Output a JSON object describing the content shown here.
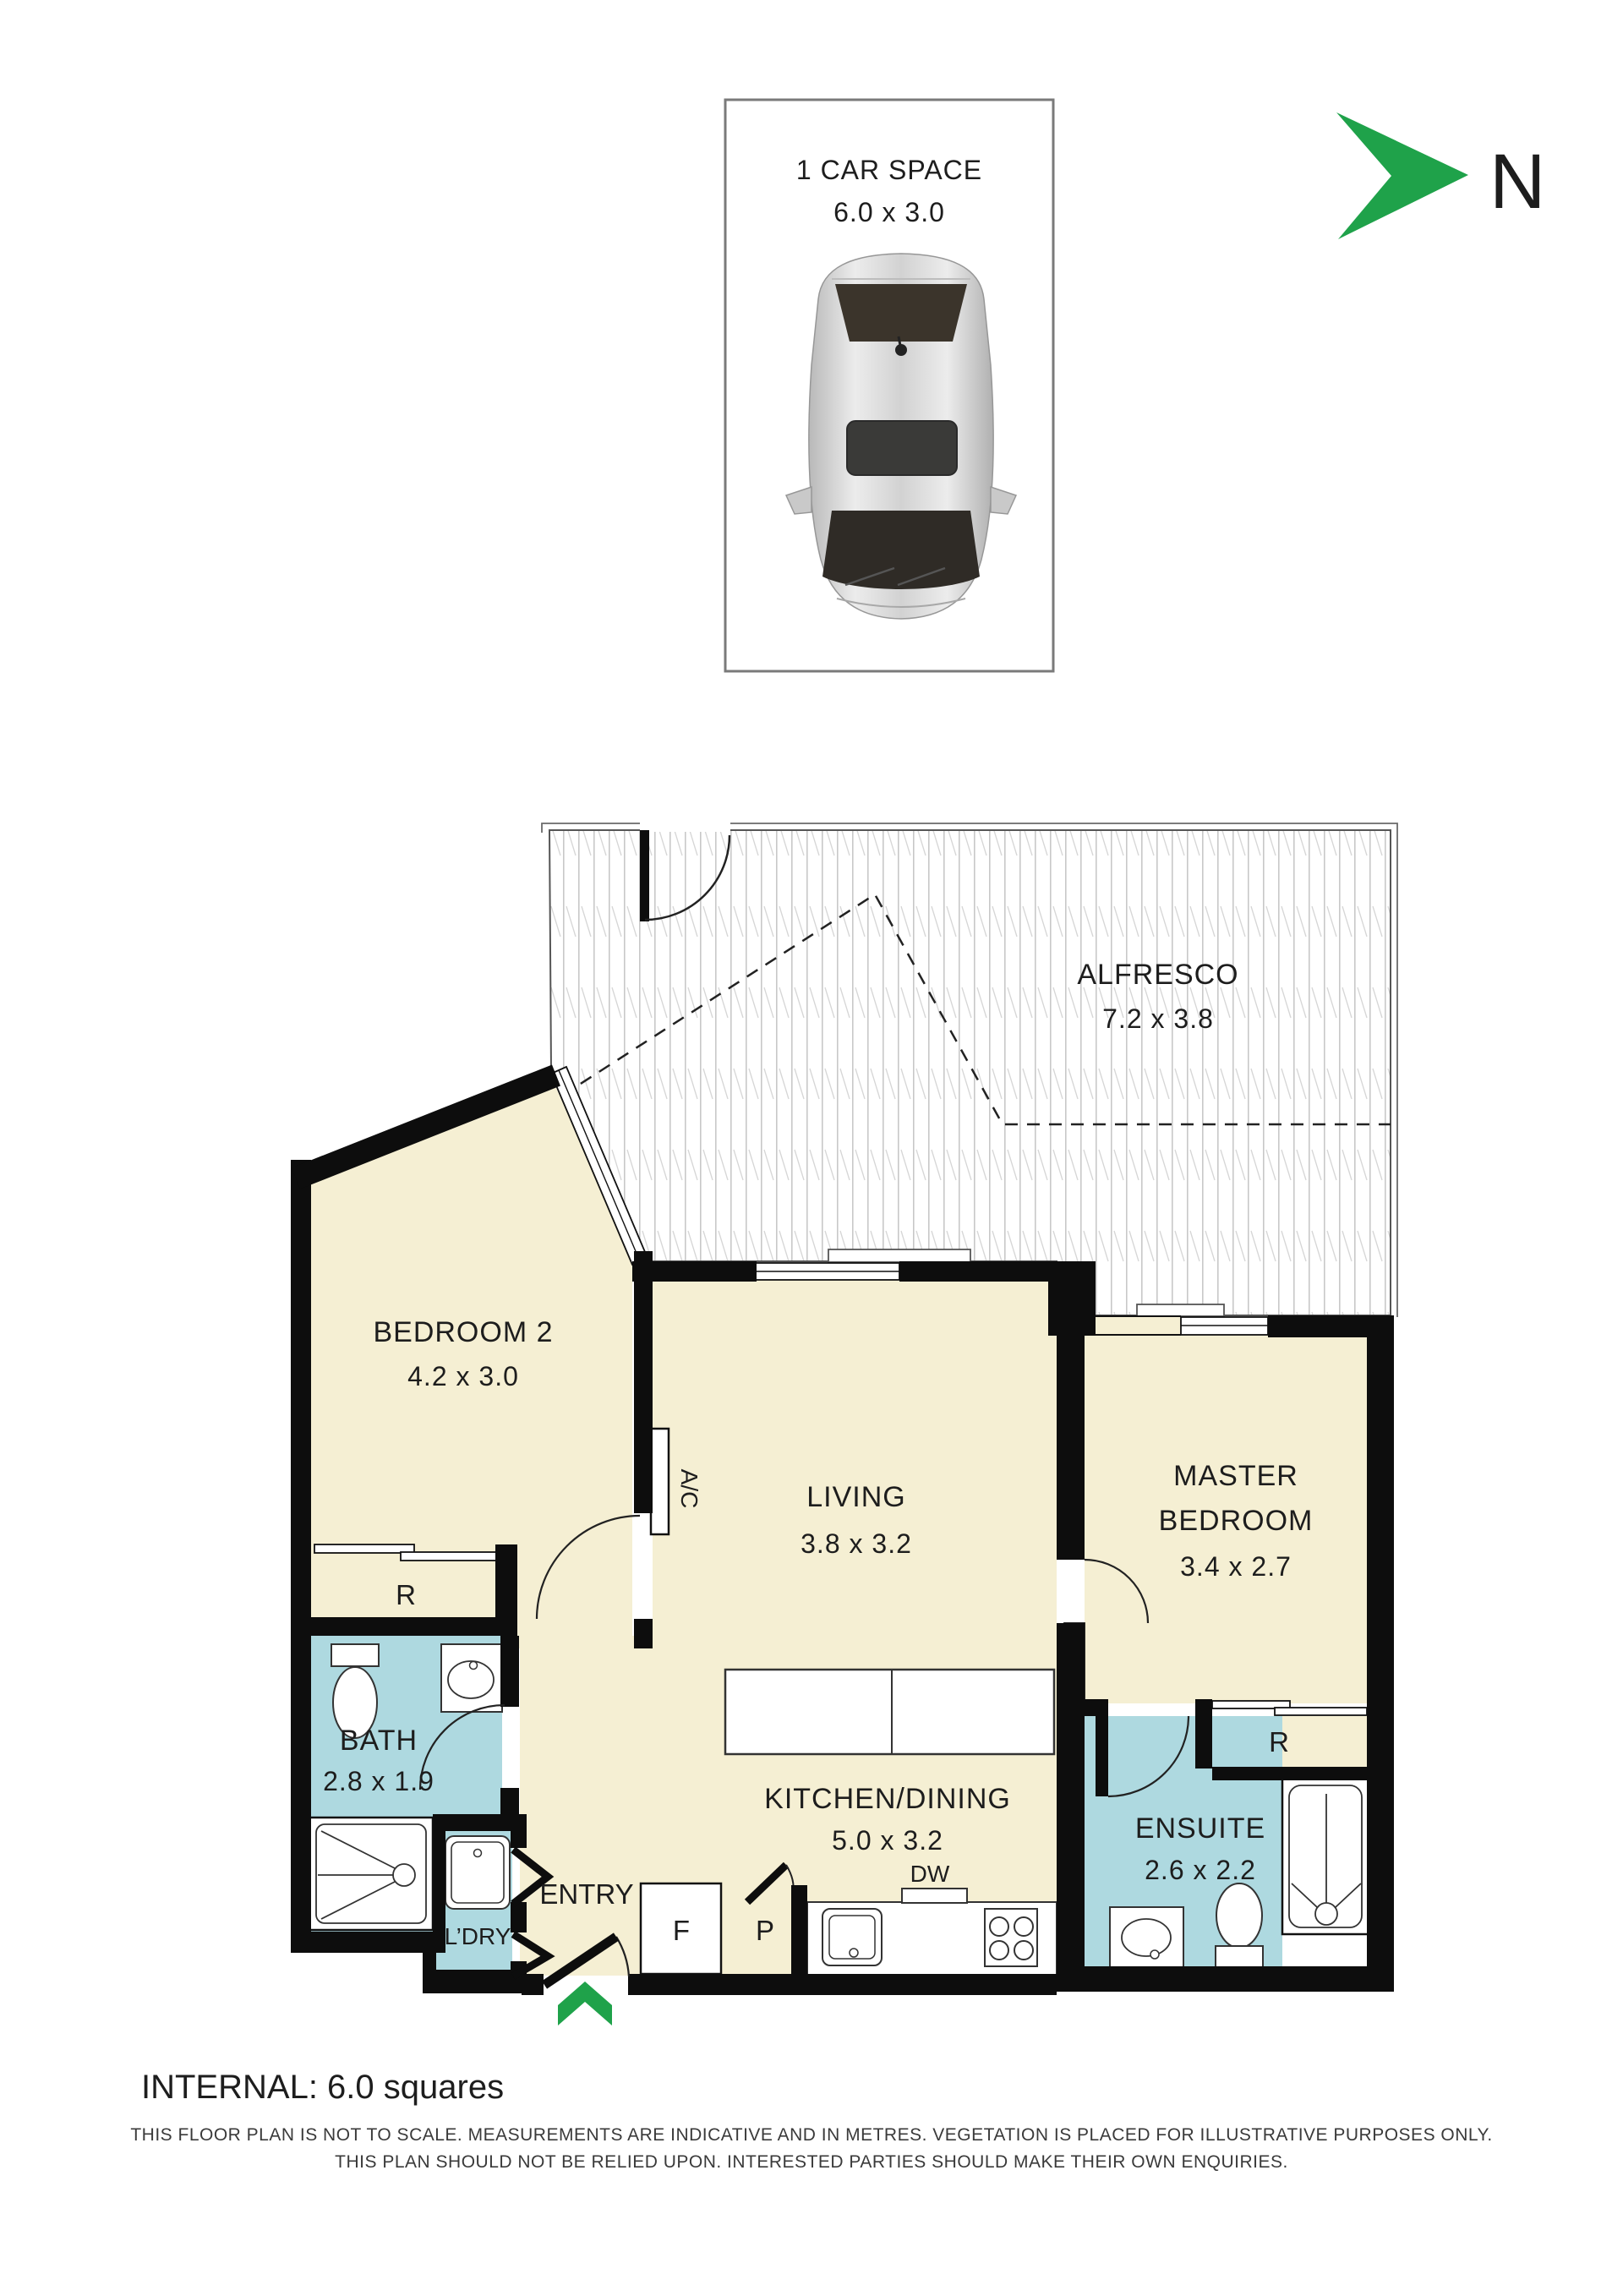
{
  "car_space": {
    "title": "1 CAR SPACE",
    "dims": "6.0 x 3.0"
  },
  "north": {
    "label": "N"
  },
  "rooms": {
    "alfresco": {
      "name": "ALFRESCO",
      "dims": "7.2 x 3.8"
    },
    "bedroom2": {
      "name": "BEDROOM 2",
      "dims": "4.2 x 3.0"
    },
    "living": {
      "name": "LIVING",
      "dims": "3.8 x 3.2"
    },
    "master": {
      "name_line1": "MASTER",
      "name_line2": "BEDROOM",
      "dims": "3.4 x 2.7"
    },
    "kitchen": {
      "name": "KITCHEN/DINING",
      "dims": "5.0 x 3.2"
    },
    "bath": {
      "name": "BATH",
      "dims": "2.8 x 1.9"
    },
    "ensuite": {
      "name": "ENSUITE",
      "dims": "2.6 x 2.2"
    },
    "laundry": {
      "name": "L’DRY"
    },
    "entry": {
      "name": "ENTRY"
    }
  },
  "labels": {
    "robe": "R",
    "fridge": "F",
    "pantry": "P",
    "dishwasher": "DW",
    "aircon": "A/C"
  },
  "footer": {
    "internal": "INTERNAL: 6.0 squares",
    "disclaimer_line1": "THIS FLOOR PLAN IS NOT TO SCALE. MEASUREMENTS ARE INDICATIVE AND IN METRES. VEGETATION IS PLACED FOR ILLUSTRATIVE PURPOSES ONLY.",
    "disclaimer_line2": "THIS PLAN SHOULD NOT BE RELIED UPON. INTERESTED PARTIES SHOULD MAKE THEIR OWN ENQUIRIES."
  },
  "colors": {
    "floor_cream": "#F5EFD3",
    "wet_area_blue": "#AED9E0",
    "wall_black": "#0D0D0D",
    "accent_green": "#1FA24A",
    "deck_line_gray": "#C8C8C8"
  }
}
